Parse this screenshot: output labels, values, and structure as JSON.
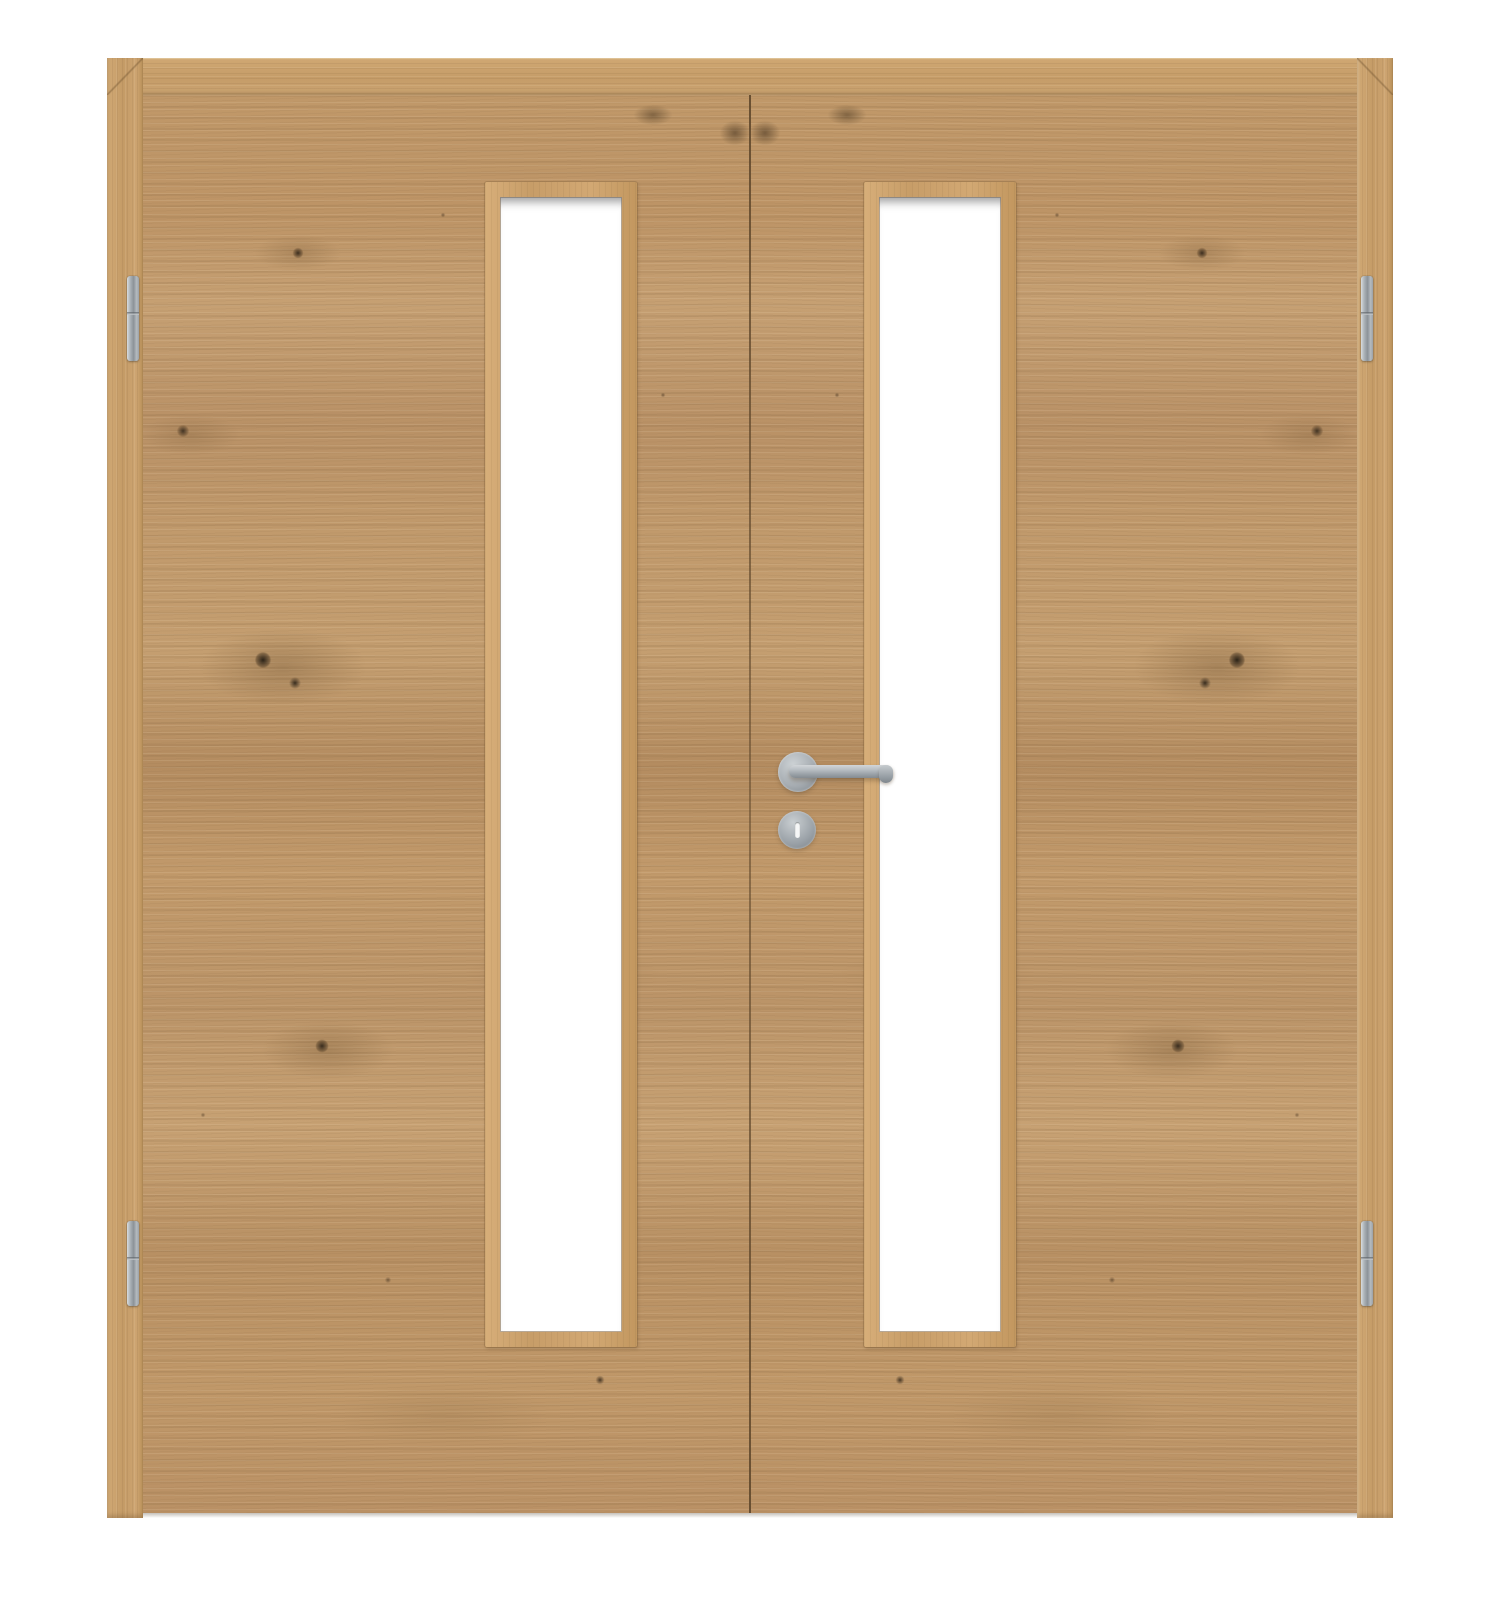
{
  "scene": {
    "subject": "Product photo of a double-leaf interior door with two vertical glass cutouts, knotty oak veneer with horizontal grain, stainless steel fittings, white background",
    "background_color": "#ffffff",
    "door": {
      "leaf_count": 2,
      "frame_label": "Oak door frame with mitered corners",
      "frame_head_label": "Door frame head",
      "frame_left_jamb_label": "Door frame left jamb",
      "frame_right_jamb_label": "Door frame right jamb",
      "leaf_left_label": "Left door leaf",
      "leaf_right_label": "Right door leaf with lever handle",
      "meeting_gap_label": "Center meeting gap between the two leaves",
      "grain_note": "horizontal knotty oak grain, mirrored between leaves"
    },
    "glass": {
      "panel_count": 2,
      "left_label": "Left vertical glass cutout with oak glazing bead",
      "right_label": "Right vertical glass cutout with oak glazing bead",
      "glass_color": "#ffffff"
    },
    "hardware": {
      "handle_label": "Stainless steel lever handle on round rosette",
      "lever_label": "Lever grip pointing right",
      "escutcheon_label": "Round escutcheon with vertical slot below handle",
      "hinge_count": 4,
      "hinge_top_left_label": "Top left hinge",
      "hinge_bottom_left_label": "Bottom left hinge",
      "hinge_top_right_label": "Top right hinge",
      "hinge_bottom_right_label": "Bottom right hinge",
      "metal_color": "#9aa1a7"
    },
    "colors": {
      "wood_base": "#c09869",
      "wood_dark_streak": "#9c7a50",
      "wood_frame": "#c89f6b",
      "glazing_bead": "#d0a76f",
      "knot": "#332a1f",
      "metal_light": "#d2d6d9",
      "metal_mid": "#9aa1a7",
      "metal_dark": "#7f868c",
      "seam": "#6e563a",
      "floor_shadow": "rgba(60,45,25,0.30)"
    }
  }
}
